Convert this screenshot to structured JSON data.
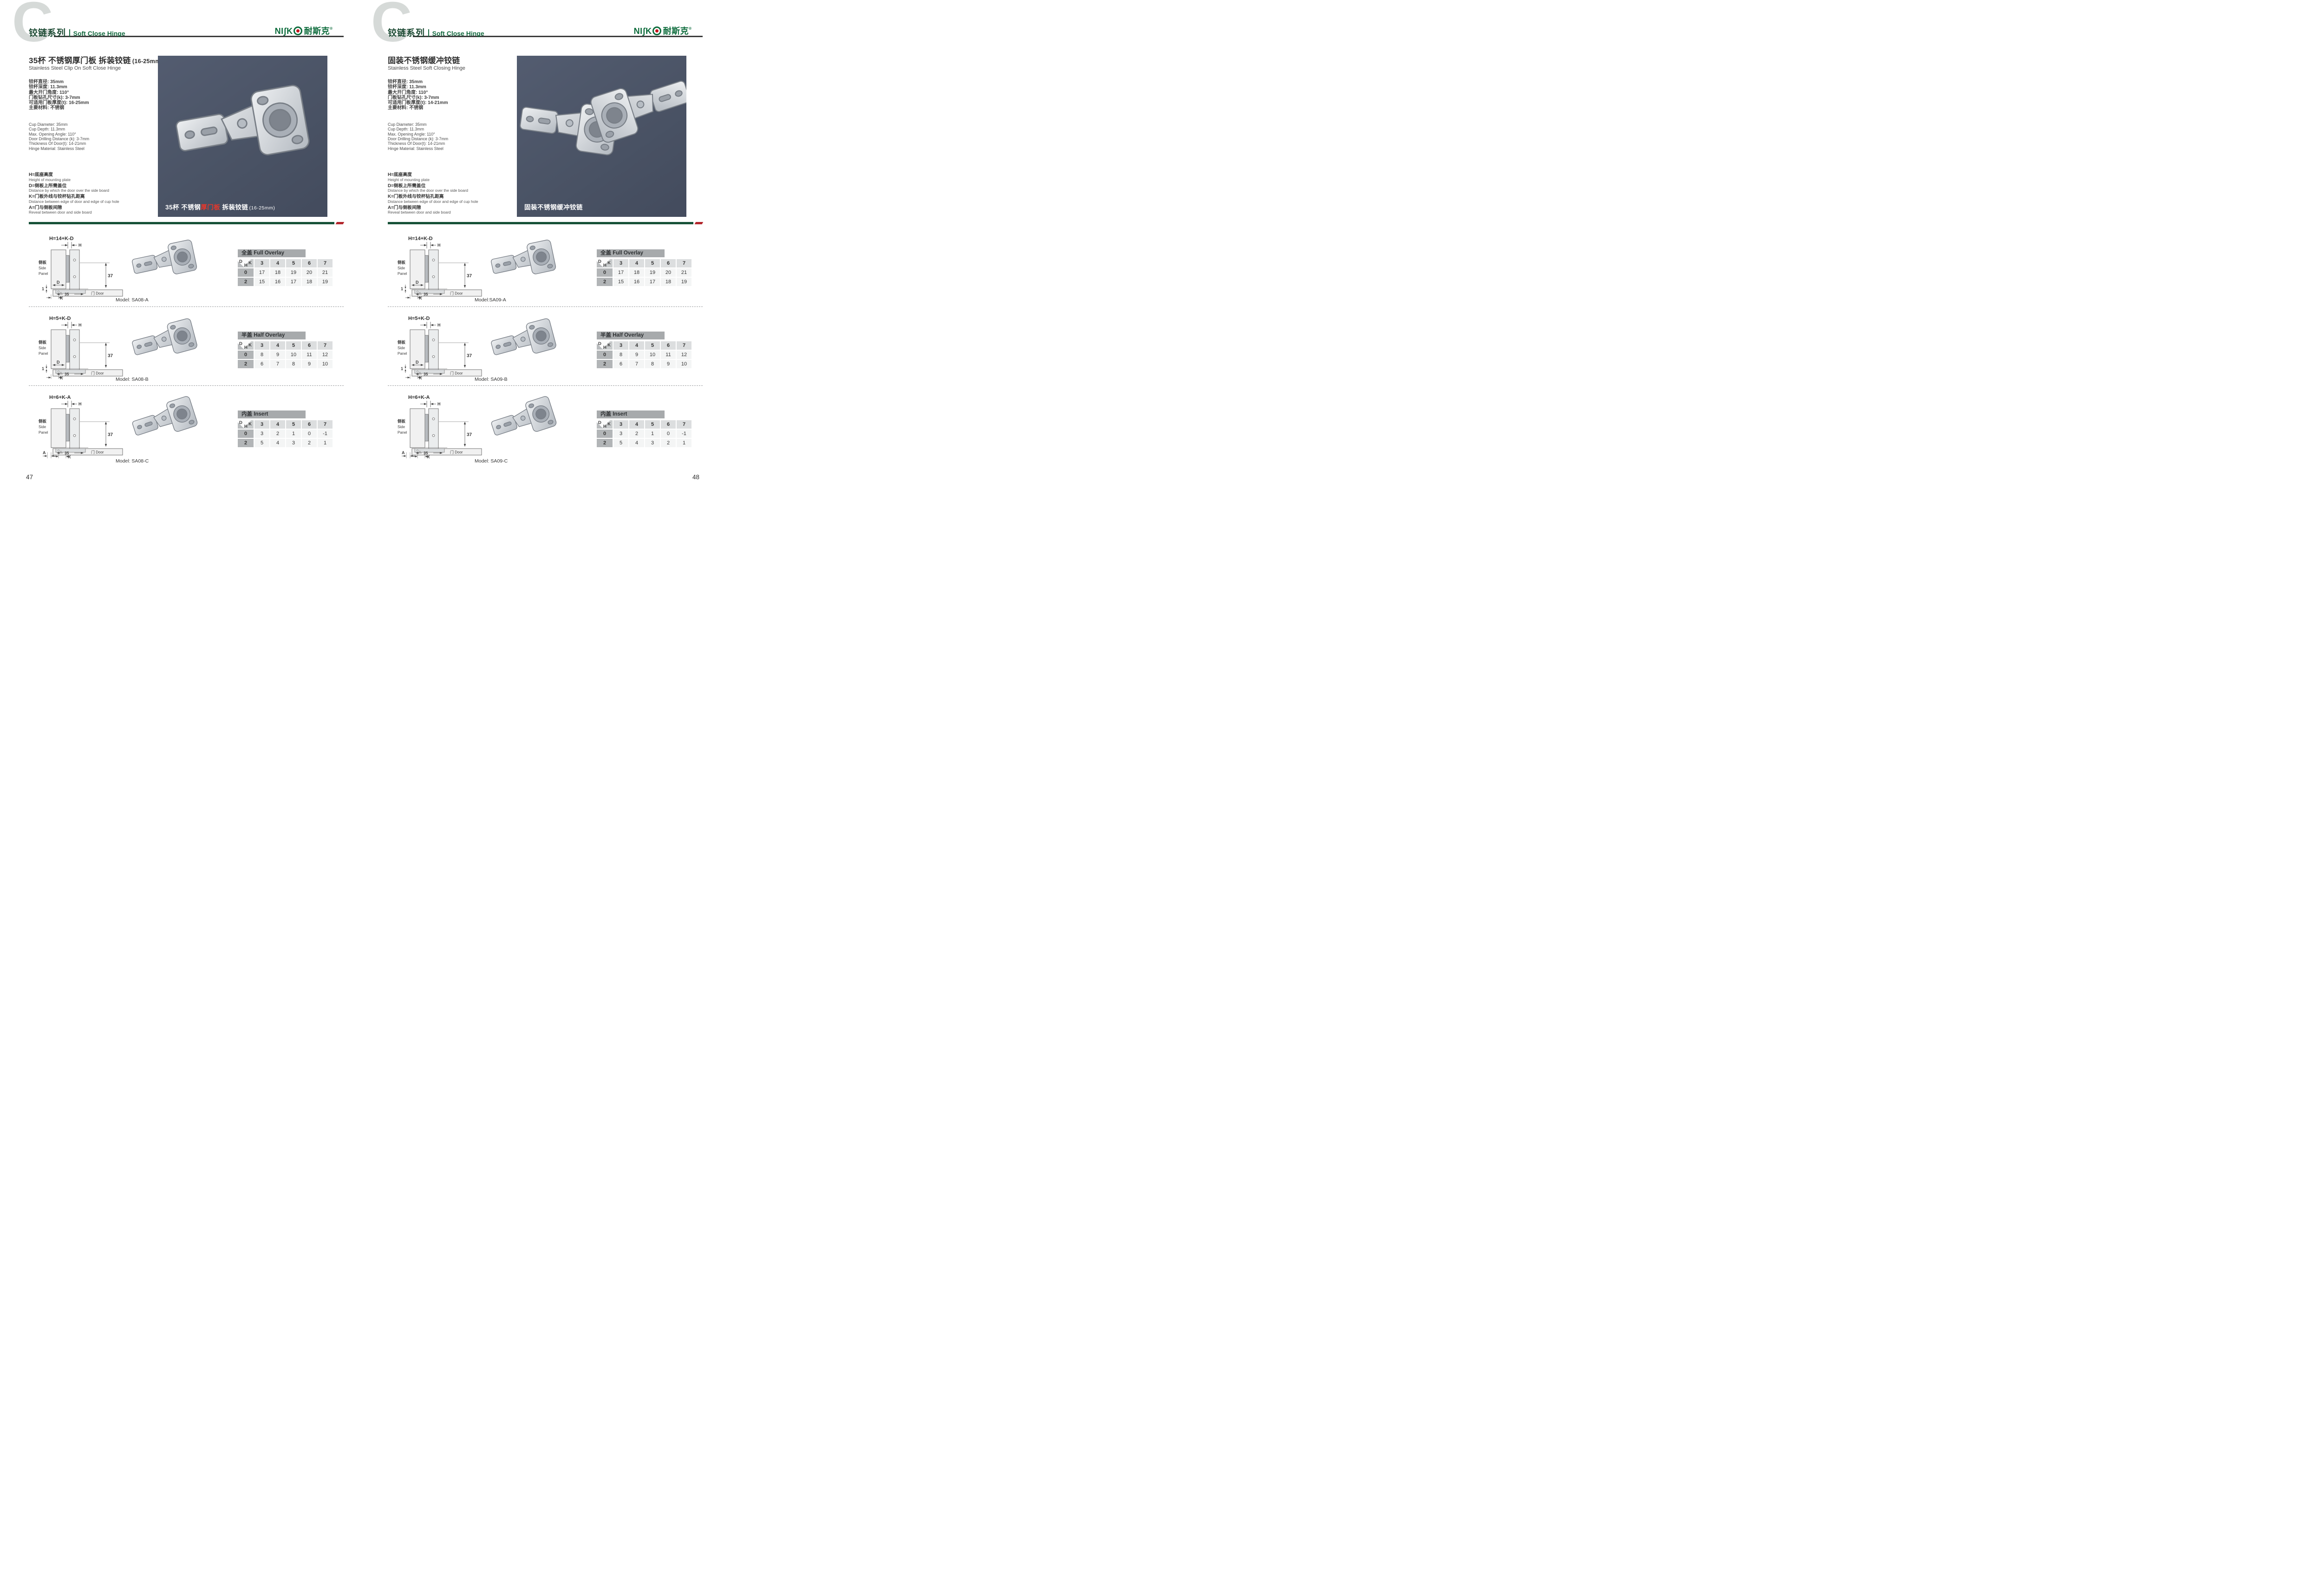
{
  "shared": {
    "c_mark": "C",
    "series_cn": "铰链系列",
    "series_en": "Soft Close Hinge",
    "logo": {
      "latin": "NIʃK",
      "cn": "耐斯克",
      "reg": "®"
    },
    "legend": [
      {
        "cn": "H=底座高度",
        "en": "Height of mounting plate"
      },
      {
        "cn": "D=侧板上所需盖位",
        "en": "Distance by which the door over the side board"
      },
      {
        "cn": "K=门板外线与铰杯钻孔距离",
        "en": "Distance between edge of door and edge of cup hole"
      },
      {
        "cn": "A=门与侧板间隙",
        "en": "Reveal between door and side board"
      }
    ],
    "diagram": {
      "h": "H",
      "side_cn": "侧板",
      "side_en1": "Side",
      "side_en2": "Panel",
      "d": "D",
      "one": "1",
      "a": "A",
      "k": "K",
      "dim_37": "37",
      "dim_35": "35",
      "door": "门 Door"
    },
    "corner": {
      "d": "D",
      "k": "K",
      "h": "H"
    },
    "k_values": [
      "3",
      "4",
      "5",
      "6",
      "7"
    ],
    "row_headers": [
      "0",
      "2"
    ],
    "tables": [
      {
        "title": "全盖 Full Overlay",
        "rows": [
          [
            "17",
            "18",
            "19",
            "20",
            "21"
          ],
          [
            "15",
            "16",
            "17",
            "18",
            "19"
          ]
        ]
      },
      {
        "title": "半盖 Half Overlay",
        "rows": [
          [
            "8",
            "9",
            "10",
            "11",
            "12"
          ],
          [
            "6",
            "7",
            "8",
            "9",
            "10"
          ]
        ]
      },
      {
        "title": "内盖 Insert",
        "rows": [
          [
            "3",
            "2",
            "1",
            "0",
            "-1"
          ],
          [
            "5",
            "4",
            "3",
            "2",
            "1"
          ]
        ]
      }
    ]
  },
  "page_left": {
    "page_no": "47",
    "title": "35杯 不锈钢厚门板 拆装铰链",
    "title_size": "(16-25mm)",
    "subtitle": "Stainless Steel Clip On Soft Close Hinge",
    "specs_cn": [
      "铰杯直径: 35mm",
      "铰杯深度: 11.3mm",
      "最大开门角度: 110°",
      "门板钻孔尺寸(k): 3-7mm",
      "可适用门板厚度(t): 16-25mm",
      "主要材料: 不锈钢"
    ],
    "specs_en": [
      "Cup Diameter: 35mm",
      "Cup Depth: 11.3mm",
      "Max. Opening Angle: 110°",
      "Door Drilling Distance (k): 3-7mm",
      "Thickness Of Door(t): 14-21mm",
      "Hinge Material: Stainless Steel"
    ],
    "caption": {
      "pre": "35杯 不锈钢",
      "red": "厚门板",
      "post": " 拆装铰链",
      "size": "(16-25mm)"
    },
    "models": [
      "Model: SA08-A",
      "Model: SA08-B",
      "Model: SA08-C"
    ],
    "formulas": [
      "H=14+K-D",
      "H=5+K-D",
      "H=6+K-A"
    ]
  },
  "page_right": {
    "page_no": "48",
    "title": "固装不锈钢缓冲铰链",
    "title_size": "",
    "subtitle": "Stainless Steel Soft Closing Hinge",
    "specs_cn": [
      "铰杯直径: 35mm",
      "铰杯深度: 11.3mm",
      "最大开门角度: 110°",
      "门板钻孔尺寸(k): 3-7mm",
      "可适用门板厚度(t): 14-21mm",
      "主要材料: 不锈钢"
    ],
    "specs_en": [
      "Cup Diameter: 35mm",
      "Cup Depth: 11.3mm",
      "Max. Opening Angle: 110°",
      "Door Drilling Distance (k): 3-7mm",
      "Thickness Of Door(t): 14-21mm",
      "Hinge Material: Stainless Steel"
    ],
    "caption": {
      "pre": "固装不锈钢缓冲铰链",
      "red": "",
      "post": "",
      "size": ""
    },
    "models": [
      "Model:SA09-A",
      "Model: SA09-B",
      "Model: SA09-C"
    ],
    "formulas": [
      "H=14+K-D",
      "H=5+K-D",
      "H=6+K-A"
    ]
  }
}
